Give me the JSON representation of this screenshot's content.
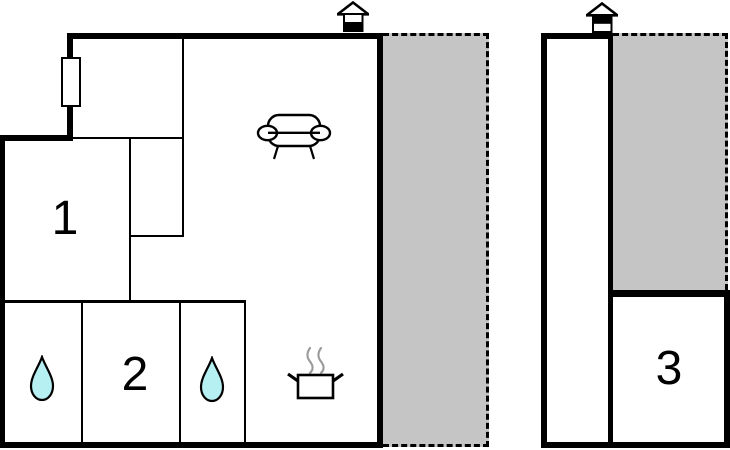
{
  "plan": {
    "type": "holiday-home floor plan, two buildings",
    "rooms": {
      "r1": "1",
      "r2": "2",
      "r3": "3"
    },
    "colors": {
      "wall": "#000000",
      "outdoor_area_fill": "#c5c5c5",
      "water_drop_fill": "#b6f0f2",
      "steam_stroke": "#9a9a9a",
      "background": "#ffffff"
    },
    "icons": {
      "left_building_marker": "house-ground-floor-icon",
      "right_building_marker": "house-upper-floor-icon",
      "bathroom_marker": "water-drop-icon",
      "living_room_marker": "sofa-icon",
      "kitchen_marker": "cooking-pot-icon",
      "window_marker": "window-icon"
    }
  }
}
